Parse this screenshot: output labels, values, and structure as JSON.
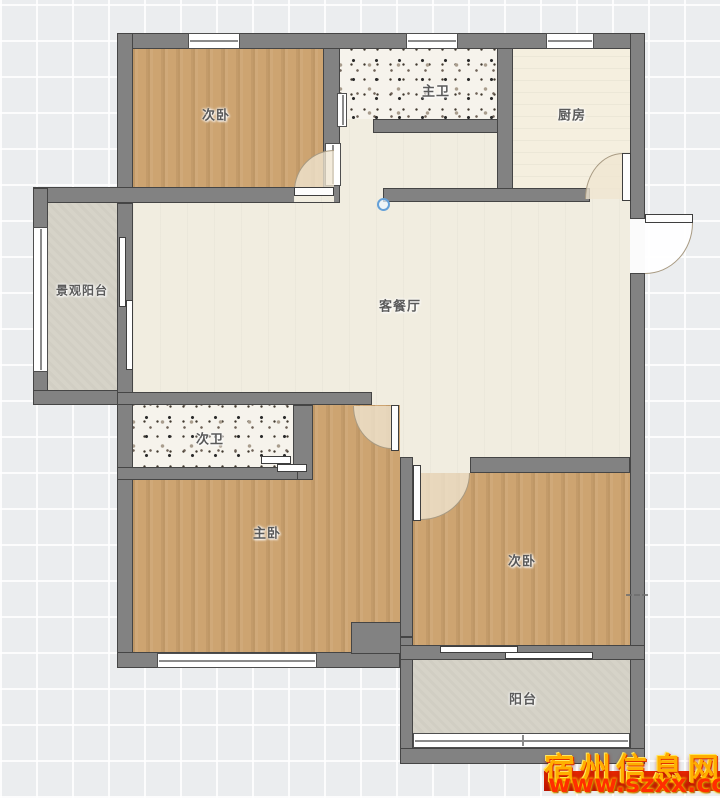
{
  "plan": {
    "rooms": {
      "bedroom_top_left": "次卧",
      "master_bath": "主卫",
      "kitchen": "厨房",
      "view_balcony": "景观阳台",
      "living_dining": "客餐厅",
      "second_bath": "次卫",
      "master_bedroom": "主卧",
      "bedroom_right": "次卧",
      "balcony": "阳台"
    },
    "colors": {
      "wall": "#828282",
      "wood_floor": "#cda471",
      "living_floor": "#f1ede0",
      "balcony_floor": "#d6d3c8",
      "marker_blue": "#64a0d8",
      "watermark_yellow": "#ffae00",
      "watermark_red": "#e82800"
    }
  },
  "watermark": {
    "site_name": "宿州信息网",
    "url": "www.szxx.com.c"
  }
}
